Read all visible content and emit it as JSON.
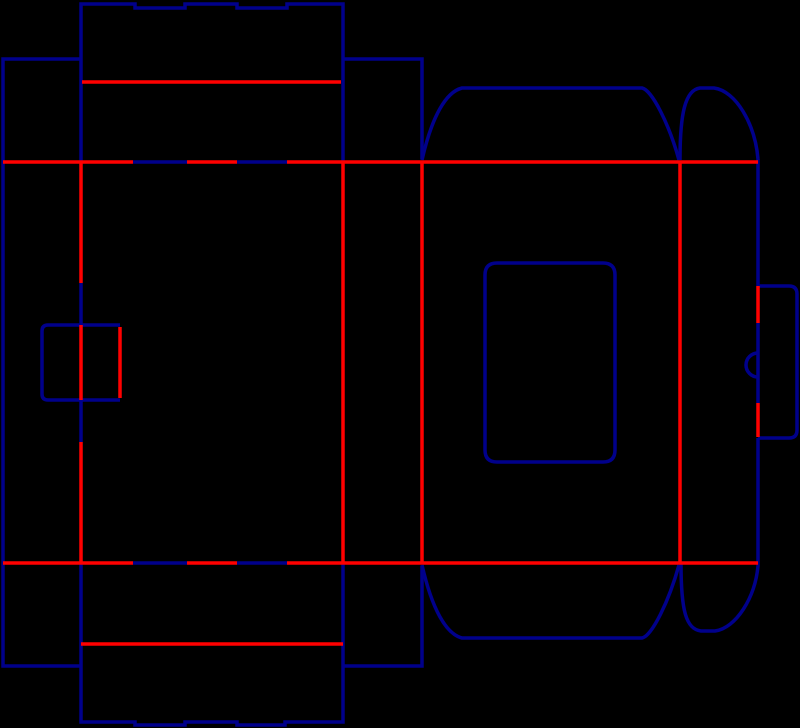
{
  "meta": {
    "title": "Box packaging dieline template",
    "background": "#000000"
  },
  "legend": {
    "cut_line_color": "#00008B",
    "crease_line_color": "#FF0000",
    "cut_line_meaning": "cut",
    "crease_line_meaning": "crease-fold"
  },
  "dieline": {
    "canvas": {
      "width": 800,
      "height": 728,
      "background": "#000000"
    },
    "styles": {
      "cut": {
        "color": "#00008B",
        "width": 3.5
      },
      "crease": {
        "color": "#FF0000",
        "width": 3.5
      }
    },
    "cuts": [
      {
        "name": "top-lid-outline-with-notches",
        "d": "M 81 162 L 81 4 L 135 4 L 135 8 L 185 8 L 185 4 L 237 4 L 237 8 L 287 8 L 287 4 L 343 4 L 343 162"
      },
      {
        "name": "left-side-panel-outline",
        "d": "M 81 59 L 3 59 L 3 666 L 81 666"
      },
      {
        "name": "top-dust-flap-rect",
        "d": "M 343 59 L 422 59 L 422 159"
      },
      {
        "name": "top-trapezoid-dust-flap",
        "d": "M 422 160 C 432 116 446 92 462 88 L 642 88 C 652 90 669 124 679 160"
      },
      {
        "name": "top-ear-flap",
        "d": "M 680 160 C 680 114 685 90 700 88 L 714 88 C 736 91 755 124 758 159"
      },
      {
        "name": "right-edge-upper",
        "d": "M 758 159 L 758 286"
      },
      {
        "name": "tuck-lock-tab-outline",
        "d": "M 758 286 L 789 286 Q 797 286 797 294 L 797 430 Q 797 438 789 438 L 758 438"
      },
      {
        "name": "tab-slit-cut",
        "d": "M 758 323 L 758 403"
      },
      {
        "name": "thumb-notch-arc",
        "d": "M 758 353 A 12 12 0 0 0 758 377"
      },
      {
        "name": "right-edge-lower",
        "d": "M 758 438 L 758 563"
      },
      {
        "name": "window-cutout",
        "d": "M 485 275 Q 485 263 497 263 L 603 263 Q 615 263 615 275 L 615 450 Q 615 462 603 462 L 497 462 Q 485 462 485 450 Z"
      },
      {
        "name": "left-pull-tab-outline",
        "d": "M 120 325 L 48 325 Q 42 325 42 331 L 42 394 Q 42 400 48 400 L 120 400"
      },
      {
        "name": "fold-cut-dash-top-a",
        "d": "M 133 162 L 187 162"
      },
      {
        "name": "fold-cut-dash-top-b",
        "d": "M 237 162 L 287 162"
      },
      {
        "name": "fold-cut-dash-bottom-a",
        "d": "M 133 563 L 187 563"
      },
      {
        "name": "fold-cut-dash-bottom-b",
        "d": "M 237 563 L 287 563"
      },
      {
        "name": "fold-cut-dash-left-upper",
        "d": "M 81 283 L 81 325"
      },
      {
        "name": "fold-cut-dash-left-lower",
        "d": "M 81 400 L 81 442"
      },
      {
        "name": "bottom-flap-outline-with-notches",
        "d": "M 81 563 L 81 722 L 135 722 L 135 725 L 185 725 L 185 722 L 237 722 L 237 725 L 285 725 L 285 722 L 343 722 L 343 563"
      },
      {
        "name": "bottom-dust-flap-rect",
        "d": "M 343 666 L 422 666 L 422 566"
      },
      {
        "name": "bottom-trapezoid-dust-flap",
        "d": "M 422 565 C 432 609 446 634 462 638 L 642 638 C 652 636 669 601 679 565"
      },
      {
        "name": "bottom-ear-flap",
        "d": "M 681 563 C 681 611 686 629 701 631 L 715 631 C 736 628 755 598 758 566 L 758 563"
      }
    ],
    "creases": [
      {
        "name": "lid-tuck-crease",
        "d": "M 82 82 L 341 82"
      },
      {
        "name": "top-main-crease-a",
        "d": "M 3 162 L 133 162"
      },
      {
        "name": "top-main-crease-b",
        "d": "M 187 162 L 237 162"
      },
      {
        "name": "top-main-crease-c",
        "d": "M 287 162 L 758 162"
      },
      {
        "name": "bottom-main-crease-a",
        "d": "M 3 563 L 133 563"
      },
      {
        "name": "bottom-main-crease-b",
        "d": "M 187 563 L 237 563"
      },
      {
        "name": "bottom-main-crease-c",
        "d": "M 287 563 L 758 563"
      },
      {
        "name": "panel1-fold-upper",
        "d": "M 81 162 L 81 283"
      },
      {
        "name": "panel1-fold-through-tab",
        "d": "M 81 325 L 81 400"
      },
      {
        "name": "panel1-fold-lower",
        "d": "M 81 442 L 81 563"
      },
      {
        "name": "left-tab-crease",
        "d": "M 120 327 L 120 398"
      },
      {
        "name": "panel2-panel3-fold",
        "d": "M 343 162 L 343 563"
      },
      {
        "name": "panel3-panel4-fold",
        "d": "M 422 162 L 422 563"
      },
      {
        "name": "panel4-panel5-fold",
        "d": "M 680 162 L 680 563"
      },
      {
        "name": "tuck-tab-fold-upper",
        "d": "M 758 286 L 758 323"
      },
      {
        "name": "tuck-tab-fold-lower",
        "d": "M 758 403 L 758 437"
      },
      {
        "name": "bottom-tuck-crease",
        "d": "M 81 644 L 343 644"
      }
    ]
  }
}
